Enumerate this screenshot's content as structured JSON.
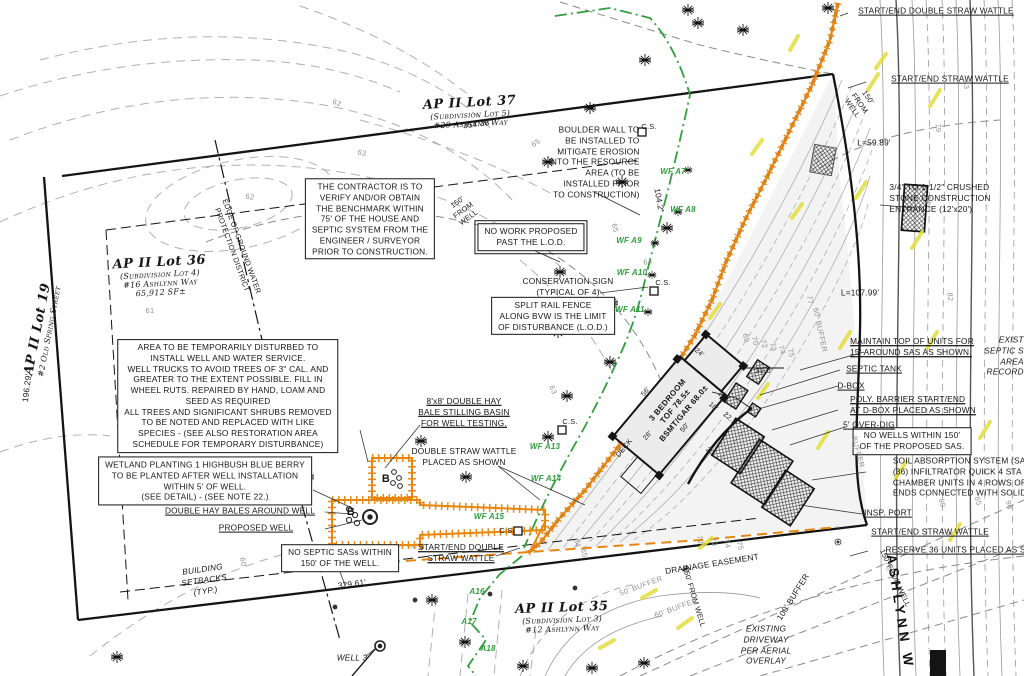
{
  "colors": {
    "barrier_orange": "#e8860d",
    "wetland_green": "#2fa03c",
    "highlight_yellow": "#e3de3c",
    "contour_gray": "#a5a5a5",
    "line_black": "#161616"
  },
  "lot_blocks": [
    {
      "name": "lot-37-label",
      "cls": "lot",
      "x": 470,
      "y": 112,
      "r": -3,
      "title": "AP II Lot 37",
      "lines": [
        "(Subdivision Lot 5)",
        "#20 Ashlynn Way"
      ]
    },
    {
      "name": "lot-36-label",
      "cls": "lot",
      "x": 160,
      "y": 276,
      "r": -3,
      "title": "AP II Lot 36",
      "lines": [
        "(Subdivision Lot 4)",
        "#16 Ashlynn Way",
        "65,912 SF±"
      ]
    },
    {
      "name": "lot-35-label",
      "cls": "lot",
      "x": 562,
      "y": 617,
      "r": -2,
      "title": "AP II Lot 35",
      "lines": [
        "(Subdivision Lot 3)",
        "#12 Ashlynn Way"
      ]
    },
    {
      "name": "lot-19-label",
      "cls": "lot",
      "x": 42,
      "y": 330,
      "r": -79,
      "title": "AP II Lot 19",
      "lines": [
        "#2 Old Spring Street"
      ]
    }
  ],
  "note_boxes": [
    {
      "name": "contractor-note",
      "box": true,
      "x": 370,
      "y": 219,
      "lines": [
        "THE CONTRACTOR IS TO",
        "VERIFY AND/OR OBTAIN",
        "THE BENCHMARK WITHIN",
        "75' OF THE HOUSE AND",
        "SEPTIC SYSTEM FROM THE",
        "ENGINEER / SURVEYOR",
        "PRIOR TO CONSTRUCTION."
      ]
    },
    {
      "name": "temporary-disturbance-note",
      "box": true,
      "x": 228,
      "y": 396,
      "lines": [
        "AREA TO BE TEMPORARILY DISTURBED TO",
        "INSTALL WELL AND WATER SERVICE.",
        "WELL TRUCKS TO AVOID TREES OF 3\" CAL. AND",
        "GREATER TO THE EXTENT POSSIBLE. FILL IN",
        "WHEEL RUTS. REPAIRED BY HAND, LOAM AND",
        "SEED AS REQUIRED",
        "ALL TREES AND SIGNIFICANT SHRUBS REMOVED",
        "TO BE NOTED AND REPLACED WITH LIKE",
        "SPECIES - (SEE ALSO RESTORATION AREA",
        "SCHEDULE FOR TEMPORARY DISTURBANCE)"
      ]
    },
    {
      "name": "wetland-planting-note",
      "box": true,
      "x": 205,
      "y": 481,
      "lines": [
        "WETLAND PLANTING 1 HIGHBUSH BLUE BERRY",
        "TO BE PLANTED AFTER WELL INSTALLATION",
        "WITHIN 5' OF WELL.",
        "(SEE DETAIL) - (SEE NOTE 22.)"
      ]
    },
    {
      "name": "no-work-note",
      "box": true,
      "dbl": true,
      "x": 531,
      "y": 237,
      "lines": [
        "NO WORK PROPOSED",
        "PAST THE L.O.D."
      ]
    },
    {
      "name": "split-rail-note",
      "box": true,
      "x": 553,
      "y": 316,
      "lines": [
        "SPLIT RAIL FENCE",
        "ALONG BVW IS THE LIMIT",
        "OF DISTURBANCE (L.O.D.)"
      ]
    },
    {
      "name": "no-septic-note",
      "box": true,
      "x": 340,
      "y": 558,
      "lines": [
        "NO SEPTIC SASs WITHIN",
        "150' OF THE WELL."
      ]
    },
    {
      "name": "no-wells-note",
      "box": true,
      "x": 912,
      "y": 441,
      "lines": [
        "NO WELLS WITHIN 150'",
        "OF THE PROPOSED SAS."
      ]
    }
  ],
  "labels": [
    {
      "name": "start-end-double-straw-wattle-top",
      "cls": "u",
      "x": 936,
      "y": 11,
      "text": "START/END DOUBLE STRAW WATTLE"
    },
    {
      "name": "start-end-straw-wattle-top",
      "cls": "u",
      "x": 950,
      "y": 79,
      "text": "START/END STRAW WATTLE"
    },
    {
      "name": "curve-length-59",
      "x": 874,
      "y": 143,
      "text": "L=59.89'"
    },
    {
      "name": "crushed-stone-entrance",
      "cls": "la",
      "x": 940,
      "y": 198,
      "lines": [
        "3/4\" TO 1-1/2\" CRUSHED",
        "STONE CONSTRUCTION",
        "ENTRANCE (12'x20')"
      ]
    },
    {
      "name": "curve-length-107",
      "x": 860,
      "y": 293,
      "text": "L=107.99'"
    },
    {
      "name": "maintain-top-units",
      "cls": "u la",
      "x": 912,
      "y": 347,
      "lines": [
        "MAINTAIN TOP OF UNITS FOR",
        "15' AROUND SAS AS SHOWN."
      ]
    },
    {
      "name": "septic-tank-label",
      "cls": "u",
      "x": 874,
      "y": 369,
      "text": "SEPTIC TANK"
    },
    {
      "name": "d-box-label",
      "cls": "u",
      "x": 851,
      "y": 386,
      "text": "D-BOX"
    },
    {
      "name": "poly-barrier-label",
      "cls": "u la",
      "x": 913,
      "y": 405,
      "lines": [
        "POLY. BARRIER START/END",
        "AT D-BOX PLACED AS SHOWN"
      ]
    },
    {
      "name": "over-dig-label",
      "cls": "u",
      "x": 869,
      "y": 425,
      "text": "5' OVER-DIG"
    },
    {
      "name": "exist-septic-record",
      "cls": "it ra",
      "x": 1004,
      "y": 356,
      "lines": [
        "EXIST",
        "SEPTIC S",
        "AREA",
        "RECORD"
      ]
    },
    {
      "name": "soil-absorption-note",
      "cls": "la",
      "x": 962,
      "y": 477,
      "lines": [
        "SOIL ABSORPTION SYSTEM (SAS",
        "(36) INFILTRATOR QUICK 4 STA",
        "CHAMBER UNITS IN 4 ROWS OF",
        "ENDS CONNECTED WITH SOLID"
      ]
    },
    {
      "name": "insp-port-label",
      "cls": "u",
      "x": 888,
      "y": 513,
      "text": "INSP. PORT"
    },
    {
      "name": "start-end-straw-wattle-right",
      "cls": "u",
      "x": 930,
      "y": 532,
      "text": "START/END STRAW WATTLE"
    },
    {
      "name": "reserve-units-label",
      "cls": "u",
      "x": 962,
      "y": 550,
      "text": "RESERVE 36 UNITS PLACED AS SHO"
    },
    {
      "name": "drainage-easement-label",
      "x": 712,
      "y": 564,
      "r": -9,
      "text": "DRAINAGE EASEMENT"
    },
    {
      "name": "buffer-100-label",
      "x": 793,
      "y": 597,
      "r": -58,
      "text": "100' BUFFER"
    },
    {
      "name": "existing-driveway-label",
      "cls": "it",
      "x": 766,
      "y": 645,
      "lines": [
        "EXISTING",
        "DRIVEWAY",
        "PER AERIAL",
        "OVERLAY"
      ]
    },
    {
      "name": "ashlynn-way-road-label",
      "cls": "road",
      "x": 900,
      "y": 612,
      "r": 81,
      "text": "ASHLYNN W"
    },
    {
      "name": "from-well-150-topright",
      "cls": "sm",
      "x": 860,
      "y": 103,
      "r": 55,
      "lines": [
        "150'",
        "FROM",
        "WELL"
      ]
    },
    {
      "name": "from-well-150-bottomright",
      "cls": "sm",
      "x": 895,
      "y": 578,
      "r": 65,
      "text": "150' FROM WELL"
    },
    {
      "name": "from-well-150-bottomleft",
      "cls": "sm",
      "x": 694,
      "y": 597,
      "r": 73,
      "text": "150' FROM WELL"
    },
    {
      "name": "dim-354",
      "x": 477,
      "y": 124,
      "r": -7,
      "text": "354.38'"
    },
    {
      "name": "dim-329",
      "x": 352,
      "y": 584,
      "r": -7,
      "text": "329.61'"
    },
    {
      "name": "dim-196",
      "x": 27,
      "y": 388,
      "r": -83,
      "text": "196.29'"
    },
    {
      "name": "dim-104",
      "x": 659,
      "y": 200,
      "r": 80,
      "text": "104.2'"
    },
    {
      "name": "boulder-wall-note",
      "cls": "ra",
      "x": 594,
      "y": 162,
      "lines": [
        "BOULDER WALL TO",
        "BE INSTALLED TO",
        "MITIGATE EROSION",
        "INTO THE RESOURCE",
        "AREA (TO BE",
        "INSTALLED PRIOR",
        "TO CONSTRUCTION)"
      ]
    },
    {
      "name": "from-well-150-center",
      "cls": "sm",
      "x": 463,
      "y": 210,
      "r": -36,
      "lines": [
        "150'",
        "FROM",
        "WELL"
      ]
    },
    {
      "name": "conservation-sign-label",
      "x": 568,
      "y": 287,
      "lines": [
        "CONSERVATION SIGN",
        "(TYPICAL OF 4)"
      ]
    },
    {
      "name": "hay-bale-basin-label",
      "cls": "u",
      "x": 464,
      "y": 412,
      "lines": [
        "8'x8' DOUBLE HAY",
        "BALE STILLING BASIN",
        "FOR WELL TESTING."
      ]
    },
    {
      "name": "double-straw-wattle-label",
      "x": 464,
      "y": 457,
      "lines": [
        "DOUBLE STRAW WATTLE",
        "PLACED AS SHOWN"
      ]
    },
    {
      "name": "start-end-double-straw-wattle-bottom",
      "cls": "u",
      "x": 461,
      "y": 553,
      "lines": [
        "START/END DOUBLE",
        "STRAW WATTLE"
      ]
    },
    {
      "name": "double-hay-bales-label",
      "cls": "u",
      "x": 240,
      "y": 511,
      "text": "DOUBLE HAY BALES AROUND WELL"
    },
    {
      "name": "proposed-well-label",
      "cls": "u",
      "x": 256,
      "y": 528,
      "text": "PROPOSED WELL"
    },
    {
      "name": "building-setbacks-label",
      "cls": "it",
      "x": 204,
      "y": 580,
      "r": -8,
      "lines": [
        "BUILDING",
        "SETBACKS",
        "(TYP.)"
      ]
    },
    {
      "name": "well-3-label",
      "cls": "it",
      "x": 352,
      "y": 658,
      "text": "WELL 3"
    },
    {
      "name": "groundwater-district-label",
      "cls": "sm",
      "x": 237,
      "y": 248,
      "r": 70,
      "lines": [
        "EDGE OF GROUND WATER",
        "PROTECTION DISTRICT"
      ]
    },
    {
      "name": "house-label",
      "cls": "house",
      "x": 676,
      "y": 407,
      "r": -50,
      "lines": [
        "3 BEDROOM",
        "TOF 78.5±",
        "BSMT/GAR 68.0±"
      ]
    },
    {
      "name": "deck-label",
      "cls": "sm",
      "x": 624,
      "y": 448,
      "r": -50,
      "text": "DECK"
    },
    {
      "name": "bale-b1",
      "cls": "bb",
      "x": 386,
      "y": 479,
      "text": "B"
    },
    {
      "name": "bale-b2",
      "cls": "bb",
      "x": 351,
      "y": 512,
      "text": "B"
    },
    {
      "name": "cs-1",
      "cls": "sm",
      "x": 649,
      "y": 127,
      "text": "C.S."
    },
    {
      "name": "cs-2",
      "cls": "sm",
      "x": 663,
      "y": 283,
      "text": "C.S."
    },
    {
      "name": "cs-3",
      "cls": "sm",
      "x": 570,
      "y": 422,
      "text": "C.S."
    },
    {
      "name": "cs-4",
      "cls": "sm",
      "x": 507,
      "y": 531,
      "text": "C.S."
    },
    {
      "name": "dim-31",
      "cls": "sm",
      "x": 764,
      "y": 371,
      "text": "31.0'"
    }
  ],
  "dimensions": [
    {
      "name": "dim-24",
      "text": "24'",
      "x": 699,
      "y": 353,
      "r": 40
    },
    {
      "name": "dim-56",
      "text": "56'",
      "x": 646,
      "y": 392,
      "r": -50
    },
    {
      "name": "dim-50",
      "text": "50'",
      "x": 685,
      "y": 428,
      "r": -50
    },
    {
      "name": "dim-28",
      "text": "28'",
      "x": 648,
      "y": 436,
      "r": -50
    },
    {
      "name": "dim-10",
      "text": "10'",
      "x": 713,
      "y": 407,
      "r": 40
    },
    {
      "name": "dim-221",
      "text": "22.1'",
      "x": 730,
      "y": 419,
      "r": 40
    },
    {
      "name": "dim-20",
      "text": "20'",
      "x": 710,
      "y": 452,
      "r": 40
    },
    {
      "name": "dim-12",
      "text": "12'",
      "x": 722,
      "y": 396,
      "r": 40
    }
  ],
  "wetland_flags": [
    {
      "name": "wf-a7",
      "text": "WF A7",
      "x": 673,
      "y": 172
    },
    {
      "name": "wf-a8",
      "text": "WF A8",
      "x": 683,
      "y": 210
    },
    {
      "name": "wf-a9",
      "text": "WF A9",
      "x": 629,
      "y": 241
    },
    {
      "name": "wf-a10",
      "text": "WF A10",
      "x": 632,
      "y": 273
    },
    {
      "name": "wf-a11",
      "text": "WF A11",
      "x": 630,
      "y": 310
    },
    {
      "name": "wf-a13",
      "text": "WF A13",
      "x": 545,
      "y": 447
    },
    {
      "name": "wf-a14",
      "text": "WF A14",
      "x": 546,
      "y": 479
    },
    {
      "name": "wf-a15",
      "text": "WF A15",
      "x": 489,
      "y": 517
    },
    {
      "name": "wf-a16",
      "text": "A17",
      "x": 469,
      "y": 622
    },
    {
      "name": "wf-a17",
      "text": "A16",
      "x": 477,
      "y": 592
    },
    {
      "name": "wf-a18",
      "text": "A18",
      "x": 488,
      "y": 649
    }
  ],
  "contour_labels": [
    {
      "text": "62",
      "x": 337,
      "y": 103,
      "r": 18
    },
    {
      "text": "63",
      "x": 362,
      "y": 153,
      "r": 12
    },
    {
      "text": "62",
      "x": 250,
      "y": 197,
      "r": 10
    },
    {
      "text": "61",
      "x": 150,
      "y": 311,
      "r": 0
    },
    {
      "text": "65",
      "x": 536,
      "y": 143,
      "r": -35
    },
    {
      "text": "65",
      "x": 615,
      "y": 228,
      "r": 75
    },
    {
      "text": "64",
      "x": 648,
      "y": 262,
      "r": -10
    },
    {
      "text": "63",
      "x": 553,
      "y": 390,
      "r": 68
    },
    {
      "text": "83",
      "x": 966,
      "y": 85,
      "r": 85
    },
    {
      "text": "79",
      "x": 938,
      "y": 128,
      "r": 85
    },
    {
      "text": "78",
      "x": 928,
      "y": 200,
      "r": 85
    },
    {
      "text": "82",
      "x": 950,
      "y": 297,
      "r": 85
    },
    {
      "text": "76",
      "x": 888,
      "y": 566,
      "r": 75
    },
    {
      "text": "80",
      "x": 942,
      "y": 503,
      "r": 75
    },
    {
      "text": "85",
      "x": 978,
      "y": 501,
      "r": 75
    },
    {
      "text": "90",
      "x": 1009,
      "y": 505,
      "r": 75
    },
    {
      "text": "72",
      "x": 700,
      "y": 540,
      "r": 75
    },
    {
      "text": "73",
      "x": 714,
      "y": 542,
      "r": 75
    },
    {
      "text": "74",
      "x": 727,
      "y": 544,
      "r": 75
    },
    {
      "text": "75",
      "x": 740,
      "y": 546,
      "r": 75
    },
    {
      "text": "69",
      "x": 746,
      "y": 338,
      "r": 75
    },
    {
      "text": "70",
      "x": 755,
      "y": 341,
      "r": 75
    },
    {
      "text": "72",
      "x": 764,
      "y": 344,
      "r": 75
    },
    {
      "text": "73",
      "x": 773,
      "y": 347,
      "r": 75
    },
    {
      "text": "74",
      "x": 782,
      "y": 350,
      "r": 75
    },
    {
      "text": "75",
      "x": 791,
      "y": 353,
      "r": 75
    },
    {
      "text": "77",
      "x": 810,
      "y": 300,
      "r": 80
    },
    {
      "text": "64",
      "x": 577,
      "y": 543,
      "r": 75
    },
    {
      "text": "65",
      "x": 584,
      "y": 553,
      "r": 75
    },
    {
      "text": "60",
      "x": 243,
      "y": 562,
      "r": 80
    },
    {
      "text": "60' BUFFER",
      "x": 676,
      "y": 608,
      "r": -20
    },
    {
      "text": "50' BUFFER",
      "x": 641,
      "y": 586,
      "r": -20
    },
    {
      "text": "BUFFER",
      "x": 858,
      "y": 452,
      "r": 75
    },
    {
      "text": "60' BUFFER",
      "x": 820,
      "y": 330,
      "r": 78
    }
  ]
}
